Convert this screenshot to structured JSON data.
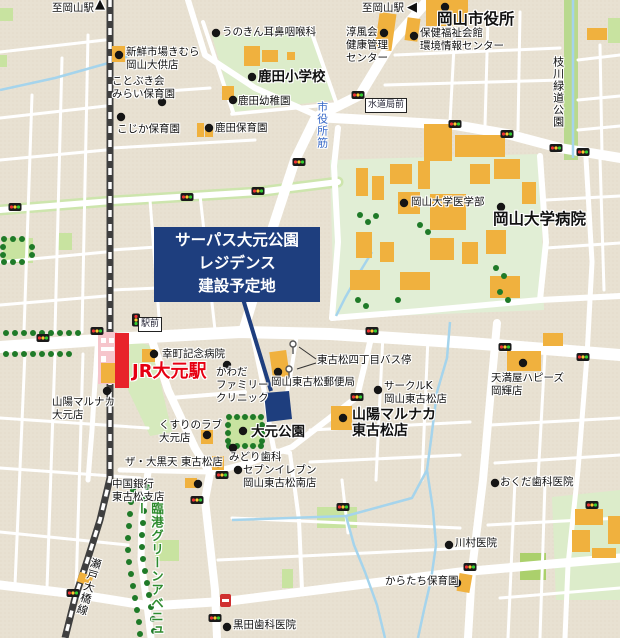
{
  "labels": {
    "to_okayama_nw": "至岡山駅",
    "to_okayama_n": "至岡山駅",
    "unokin_ent": "うのきん耳鼻咽喉科",
    "shinsen_market": "新鮮市場きむら\n岡山大供店",
    "kotobuki_mirai": "ことぶき会\nみらい保育園",
    "kojika_nursery": "こじか保育園",
    "shikata_elementary": "鹿田小学校",
    "shikata_kindergarten": "鹿田幼稚園",
    "shikata_nursery": "鹿田保育園",
    "okayama_city_hall": "岡山市役所",
    "junpukai": "淳風会\n健康管理\nセンター",
    "hoken_fukushi": "保健福祉会館\n環境情報センター",
    "edagawa_park": "枝川緑道公園",
    "suidokyoku_mae": "水道局前",
    "shiyakusho_suji": "市役所筋",
    "okayama_univ_med": "岡山大学医学部",
    "okayama_univ_hospital": "岡山大学病院",
    "site_notice": "サーパス大元公園\nレジデンス\n建設予定地",
    "ekimae": "駅前",
    "saiwaicho_hospital": "幸町記念病院",
    "jr_omoto_station": "JR大元駅",
    "kawada_clinic": "かわだ\nファミリー\nクリニック",
    "higashifurumatsu_bus": "東古松四丁目バス停",
    "higashifurumatsu_post": "岡山東古松郵便局",
    "circle_k": "サークルK\n岡山東古松店",
    "tenmaya_happys": "天満屋ハピーズ\n岡輝店",
    "marunaka_omoto": "山陽マルナカ\n大元店",
    "marunaka_higashifurumatsu": "山陽マルナカ\n東古松店",
    "omoto_park": "大元公園",
    "kusuri_love": "くすりのラブ\n大元店",
    "midori_dental": "みどり歯科",
    "daikokuten": "ザ・大黒天 東古松店",
    "seven_eleven": "セブンイレブン\n岡山東古松南店",
    "chugoku_bank": "中国銀行\n東古松支店",
    "rinko_green_avenue": "臨港グリーンアベニュー",
    "seto_ohashi_line": "瀬戸大橋線",
    "kuroda_dental": "黒田歯科医院",
    "okuda_dental": "おくだ歯科医院",
    "kawamura_clinic": "川村医院",
    "karatachi_nursery": "からたち保育園"
  },
  "icons": {
    "up_arrow": "▲",
    "left_arrow": "◀"
  },
  "colors": {
    "background_tan": "#e8e1d2",
    "road_white": "#ffffff",
    "park_green": "#c8e3a0",
    "campus_green": "#e1eed5",
    "school_green": "#dcecca",
    "building_orange": "#f0b13e",
    "station_pink": "#f6c6cc",
    "station_red": "#e8232a",
    "jr_station_text_red": "#e60012",
    "site_navy": "#1e3e7e",
    "railway_gray": "#3f3f3f",
    "water_blue": "#a5d4ec",
    "tree_green": "#1f7a28",
    "avenue_label_green": "#2e8b2e",
    "road_label_blue": "#3a6bc8",
    "signal_red": "#ee3333",
    "signal_yellow": "#ffcc33",
    "signal_green": "#33cc33"
  }
}
